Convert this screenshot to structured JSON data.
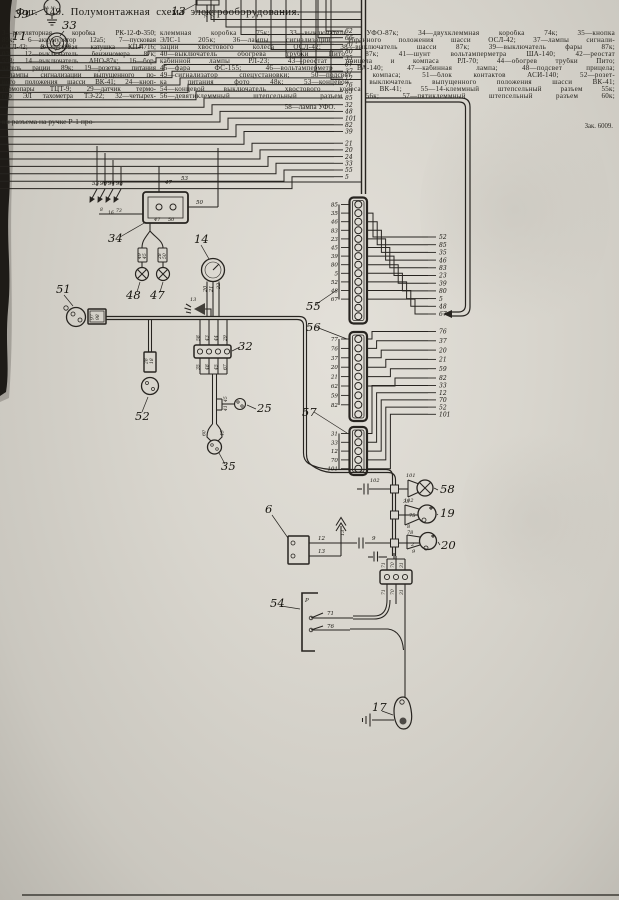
{
  "page": {
    "caption_title": "Фиг. 149. Полумонтажная схема электрооборудования.",
    "legend_left": [
      "3—регуляторная коробка РК-12-Ф-350;",
      "89к; 6—аккумулятор 12а5; 7—пусковая",
      "ОСЛ-42; 9—пусковая катушка КП-4716;",
      "03; 12—выключатель бензиномера 87к;",
      "593; 14—выключатель АНО-87к; 16—бор-",
      "чатель рации 89к; 19—розетка питания",
      "—лампы сигнализации выпущенного по-",
      "ного положения шасси ВК-41; 24—кноп-",
      "термопары ТЦТ-9; 29—датчик термо-",
      "гор ЭЛ тахометра ТЭ-22; 32—четырех-"
    ],
    "legend_right": [
      "клеммная коробка 75к; 33—выключатель УФО-87к; 34—двухклеммная коробка 74к; 35—кнопка",
      "ЭЛС-1 205к; 36—лампы сигнализации убранного положения шасси ОСЛ-42; 37—лампы сигнали-",
      "зации хвостового колеса ОСЛ-42; 38—выключатель шасси 87к; 39—выключатель фары 87к;",
      "40—выключатель обогрева трубки Пито 87к; 41—шунт вольтамперметра ША-140; 42—реостат",
      "кабинной лампы РЛ-23; 43—реостат прицела и компаса РЛ-70; 44—обогрев трубки Пито;",
      "45—фара ФС-155; 46—вольтамперметр ВА-140; 47—кабинная лампа; 48—подсвет прицела;",
      "49—сигнализатор спецустановки; 50—подсвет компаса; 51—блок контактов АСИ-140; 52—розет-",
      "ка питания фото 48к; 53—концевой выключатель выпущенного положения шасси ВК-41;",
      "54—концевой выключатель хвостового колеса ВК-41; 55—14-клеммный штепсельный разъем 55к;",
      "56—девятиклеммный штепсельный разъем 56к; 57—пятиклеммный штепсельный разъем 60к;"
    ],
    "legend_center_last": "58—лампа УФО.",
    "footer_fragment": "ки разъема на ручке Р-1 про-",
    "imprint": "Зак. 6009."
  },
  "diagram": {
    "component_labels": [
      {
        "t": "39",
        "x": 14,
        "y": 18
      },
      {
        "t": "11",
        "x": 12,
        "y": 40
      },
      {
        "t": "33",
        "x": 62,
        "y": 29
      },
      {
        "t": "13",
        "x": 171,
        "y": 15
      },
      {
        "t": "34",
        "x": 108,
        "y": 242
      },
      {
        "t": "48",
        "x": 126,
        "y": 299
      },
      {
        "t": "47",
        "x": 150,
        "y": 299
      },
      {
        "t": "14",
        "x": 194,
        "y": 243
      },
      {
        "t": "51",
        "x": 56,
        "y": 293
      },
      {
        "t": "52",
        "x": 135,
        "y": 420
      },
      {
        "t": "32",
        "x": 238,
        "y": 350
      },
      {
        "t": "25",
        "x": 257,
        "y": 412
      },
      {
        "t": "35",
        "x": 221,
        "y": 470
      },
      {
        "t": "55",
        "x": 306,
        "y": 310
      },
      {
        "t": "56",
        "x": 306,
        "y": 331
      },
      {
        "t": "57",
        "x": 302,
        "y": 416
      },
      {
        "t": "6",
        "x": 265,
        "y": 513
      },
      {
        "t": "58",
        "x": 440,
        "y": 493
      },
      {
        "t": "19",
        "x": 440,
        "y": 517
      },
      {
        "t": "20",
        "x": 441,
        "y": 549
      },
      {
        "t": "54",
        "x": 270,
        "y": 607
      },
      {
        "t": "17",
        "x": 372,
        "y": 711
      }
    ],
    "top_wire_column": [
      "62",
      "66",
      "70",
      "80",
      "35",
      "67",
      "37",
      "12",
      "76",
      "83",
      "85",
      "32",
      "48",
      "101",
      "82",
      "39",
      "21",
      "20",
      "24",
      "33",
      "55",
      "5"
    ],
    "connectors": {
      "block55": {
        "name": "55",
        "terminals": 14,
        "left_labels": [
          "85",
          "35",
          "46",
          "83",
          "23",
          "45",
          "39",
          "80",
          "5",
          "52",
          "48",
          "67"
        ]
      },
      "block56": {
        "name": "56",
        "terminals": 9,
        "left_labels": [
          "77",
          "76",
          "37",
          "20",
          "21",
          "62",
          "59",
          "82"
        ]
      },
      "block57": {
        "name": "57",
        "terminals": 5,
        "left_labels": [
          "31",
          "33",
          "12",
          "70",
          "101"
        ]
      }
    },
    "fanout_labels": [
      "52",
      "85",
      "35",
      "46",
      "83",
      "23",
      "39",
      "80",
      "5",
      "48",
      "67",
      "76",
      "37",
      "20",
      "21",
      "59",
      "82",
      "33",
      "12",
      "70",
      "52",
      "101"
    ],
    "wire_labels": [
      {
        "t": "53",
        "x": 92,
        "y": 185
      },
      {
        "t": "96",
        "x": 100,
        "y": 185
      },
      {
        "t": "94",
        "x": 108,
        "y": 185
      },
      {
        "t": "98",
        "x": 116,
        "y": 185
      },
      {
        "t": "8",
        "x": 100,
        "y": 211,
        "s": 4.5
      },
      {
        "t": "16",
        "x": 108,
        "y": 214,
        "s": 4.5
      },
      {
        "t": "73",
        "x": 116,
        "y": 212,
        "s": 4.5
      },
      {
        "t": "53",
        "x": 181,
        "y": 180
      },
      {
        "t": "47",
        "x": 165,
        "y": 184
      },
      {
        "t": "50",
        "x": 196,
        "y": 204
      },
      {
        "t": "47",
        "x": 154,
        "y": 221,
        "s": 5
      },
      {
        "t": "50",
        "x": 168,
        "y": 221,
        "s": 5
      },
      {
        "t": "49",
        "x": 141,
        "y": 259,
        "s": 4.5,
        "r": -90
      },
      {
        "t": "45",
        "x": 146,
        "y": 259,
        "s": 4.5,
        "r": -90
      },
      {
        "t": "28",
        "x": 161,
        "y": 259,
        "s": 4.5,
        "r": -90
      },
      {
        "t": "50",
        "x": 166,
        "y": 259,
        "s": 4.5,
        "r": -90
      },
      {
        "t": "20",
        "x": 206.5,
        "y": 292,
        "s": 5,
        "r": -90
      },
      {
        "t": "21",
        "x": 212.5,
        "y": 292,
        "s": 5,
        "r": -90
      },
      {
        "t": "22",
        "x": 220,
        "y": 289,
        "s": 5,
        "r": -90
      },
      {
        "t": "13",
        "x": 190,
        "y": 301,
        "s": 5
      },
      {
        "t": "97",
        "x": 93.5,
        "y": 320,
        "s": 4.5,
        "r": -90
      },
      {
        "t": "98",
        "x": 99,
        "y": 320,
        "s": 4.5,
        "r": -90
      },
      {
        "t": "28",
        "x": 147.5,
        "y": 364,
        "s": 4.5,
        "r": -90
      },
      {
        "t": "18",
        "x": 153,
        "y": 364,
        "s": 4.5,
        "r": -90
      },
      {
        "t": "58",
        "x": 199.5,
        "y": 341,
        "s": 4.5,
        "r": -90
      },
      {
        "t": "43",
        "x": 208.5,
        "y": 341,
        "s": 4.5,
        "r": -90
      },
      {
        "t": "44",
        "x": 217.5,
        "y": 341,
        "s": 4.5,
        "r": -90
      },
      {
        "t": "29",
        "x": 226.5,
        "y": 341,
        "s": 4.5,
        "r": -90
      },
      {
        "t": "35",
        "x": 199.5,
        "y": 370,
        "s": 4.5,
        "r": -90
      },
      {
        "t": "48",
        "x": 208.5,
        "y": 370,
        "s": 4.5,
        "r": -90
      },
      {
        "t": "45",
        "x": 217.5,
        "y": 370,
        "s": 4.5,
        "r": -90
      },
      {
        "t": "67",
        "x": 226.5,
        "y": 370,
        "s": 4.5,
        "r": -90
      },
      {
        "t": "45",
        "x": 227,
        "y": 402,
        "s": 4.5,
        "r": -90
      },
      {
        "t": "41",
        "x": 227,
        "y": 411,
        "s": 4.5,
        "r": -90
      },
      {
        "t": "60",
        "x": 205.5,
        "y": 436,
        "s": 4.5,
        "r": -90
      },
      {
        "t": "45",
        "x": 223.5,
        "y": 436,
        "s": 4.5,
        "r": -90
      },
      {
        "t": "28",
        "x": 207.5,
        "y": 18,
        "s": 5,
        "r": -90
      },
      {
        "t": "27",
        "x": 214.5,
        "y": 18,
        "s": 5,
        "r": -90
      },
      {
        "t": "12",
        "x": 318,
        "y": 540
      },
      {
        "t": "13",
        "x": 318,
        "y": 553
      },
      {
        "t": "13",
        "x": 344,
        "y": 536,
        "s": 5,
        "r": -90
      },
      {
        "t": "9",
        "x": 372,
        "y": 540
      },
      {
        "t": "101",
        "x": 406,
        "y": 477,
        "s": 5
      },
      {
        "t": "102",
        "x": 404,
        "y": 502,
        "s": 5
      },
      {
        "t": "102",
        "x": 370,
        "y": 482,
        "s": 5
      },
      {
        "t": "33",
        "x": 403,
        "y": 503,
        "s": 5
      },
      {
        "t": "75",
        "x": 409,
        "y": 517,
        "s": 5
      },
      {
        "t": "8",
        "x": 407,
        "y": 528,
        "s": 5
      },
      {
        "t": "78",
        "x": 407,
        "y": 534,
        "s": 5
      },
      {
        "t": "2",
        "x": 411,
        "y": 546,
        "s": 5
      },
      {
        "t": "9",
        "x": 412,
        "y": 553,
        "s": 5
      },
      {
        "t": "71",
        "x": 385,
        "y": 568,
        "s": 4.5,
        "r": -90
      },
      {
        "t": "70",
        "x": 394,
        "y": 568,
        "s": 4.5,
        "r": -90
      },
      {
        "t": "31",
        "x": 403,
        "y": 568,
        "s": 4.5,
        "r": -90
      },
      {
        "t": "71",
        "x": 385,
        "y": 595,
        "s": 4.5,
        "r": -90
      },
      {
        "t": "70",
        "x": 394,
        "y": 595,
        "s": 4.5,
        "r": -90
      },
      {
        "t": "31",
        "x": 403,
        "y": 595,
        "s": 4.5,
        "r": -90
      },
      {
        "t": "71",
        "x": 327,
        "y": 615
      },
      {
        "t": "76",
        "x": 327,
        "y": 628
      },
      {
        "t": "Р",
        "x": 305,
        "y": 602
      },
      {
        "t": "80",
        "x": 40,
        "y": 49,
        "s": 4.5
      },
      {
        "t": "100",
        "x": 62,
        "y": 47,
        "s": 4.5
      },
      {
        "t": "М₁ М₂",
        "x": 44,
        "y": 9,
        "s": 3.8
      }
    ]
  }
}
